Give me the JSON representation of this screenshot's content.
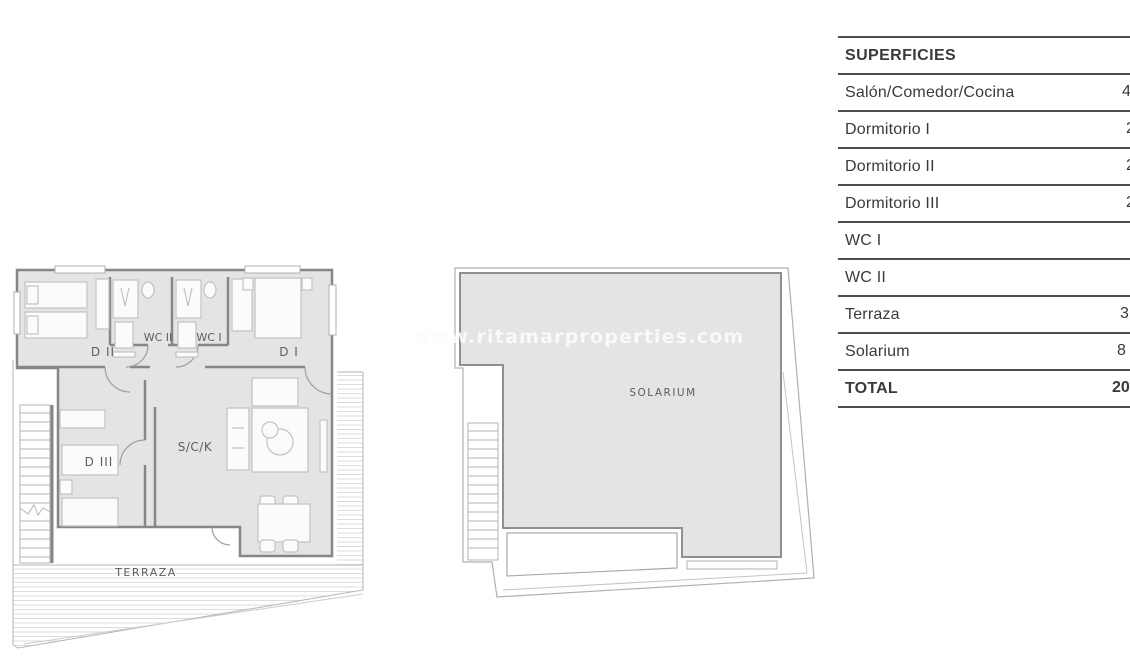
{
  "watermark": "www.ritamarproperties.com",
  "table": {
    "header": "SUPERFICIES",
    "rows": [
      {
        "label": "Salón/Comedor/Cocina",
        "value": "4"
      },
      {
        "label": "Dormitorio I",
        "value": "2"
      },
      {
        "label": "Dormitorio II",
        "value": "2"
      },
      {
        "label": "Dormitorio III",
        "value": "2"
      },
      {
        "label": "WC I",
        "value": ""
      },
      {
        "label": "WC II",
        "value": ""
      },
      {
        "label": "Terraza",
        "value": "3"
      },
      {
        "label": "Solarium",
        "value": "8"
      },
      {
        "label": "TOTAL",
        "value": "20"
      }
    ]
  },
  "floorplan": {
    "labels": {
      "d2": "D II",
      "wc2": "WC II",
      "wc1": "WC I",
      "d1": "D I",
      "d3": "D III",
      "sck": "S/C/K",
      "terraza": "TERRAZA",
      "solarium": "SOLARIUM"
    }
  },
  "colors": {
    "plan_fill": "#e4e4e4",
    "wall": "#868686",
    "furniture_line": "#c2c2c2",
    "hatch_line": "#dedede",
    "table_line": "#4e4e4e",
    "text": "#3a3a3a"
  }
}
